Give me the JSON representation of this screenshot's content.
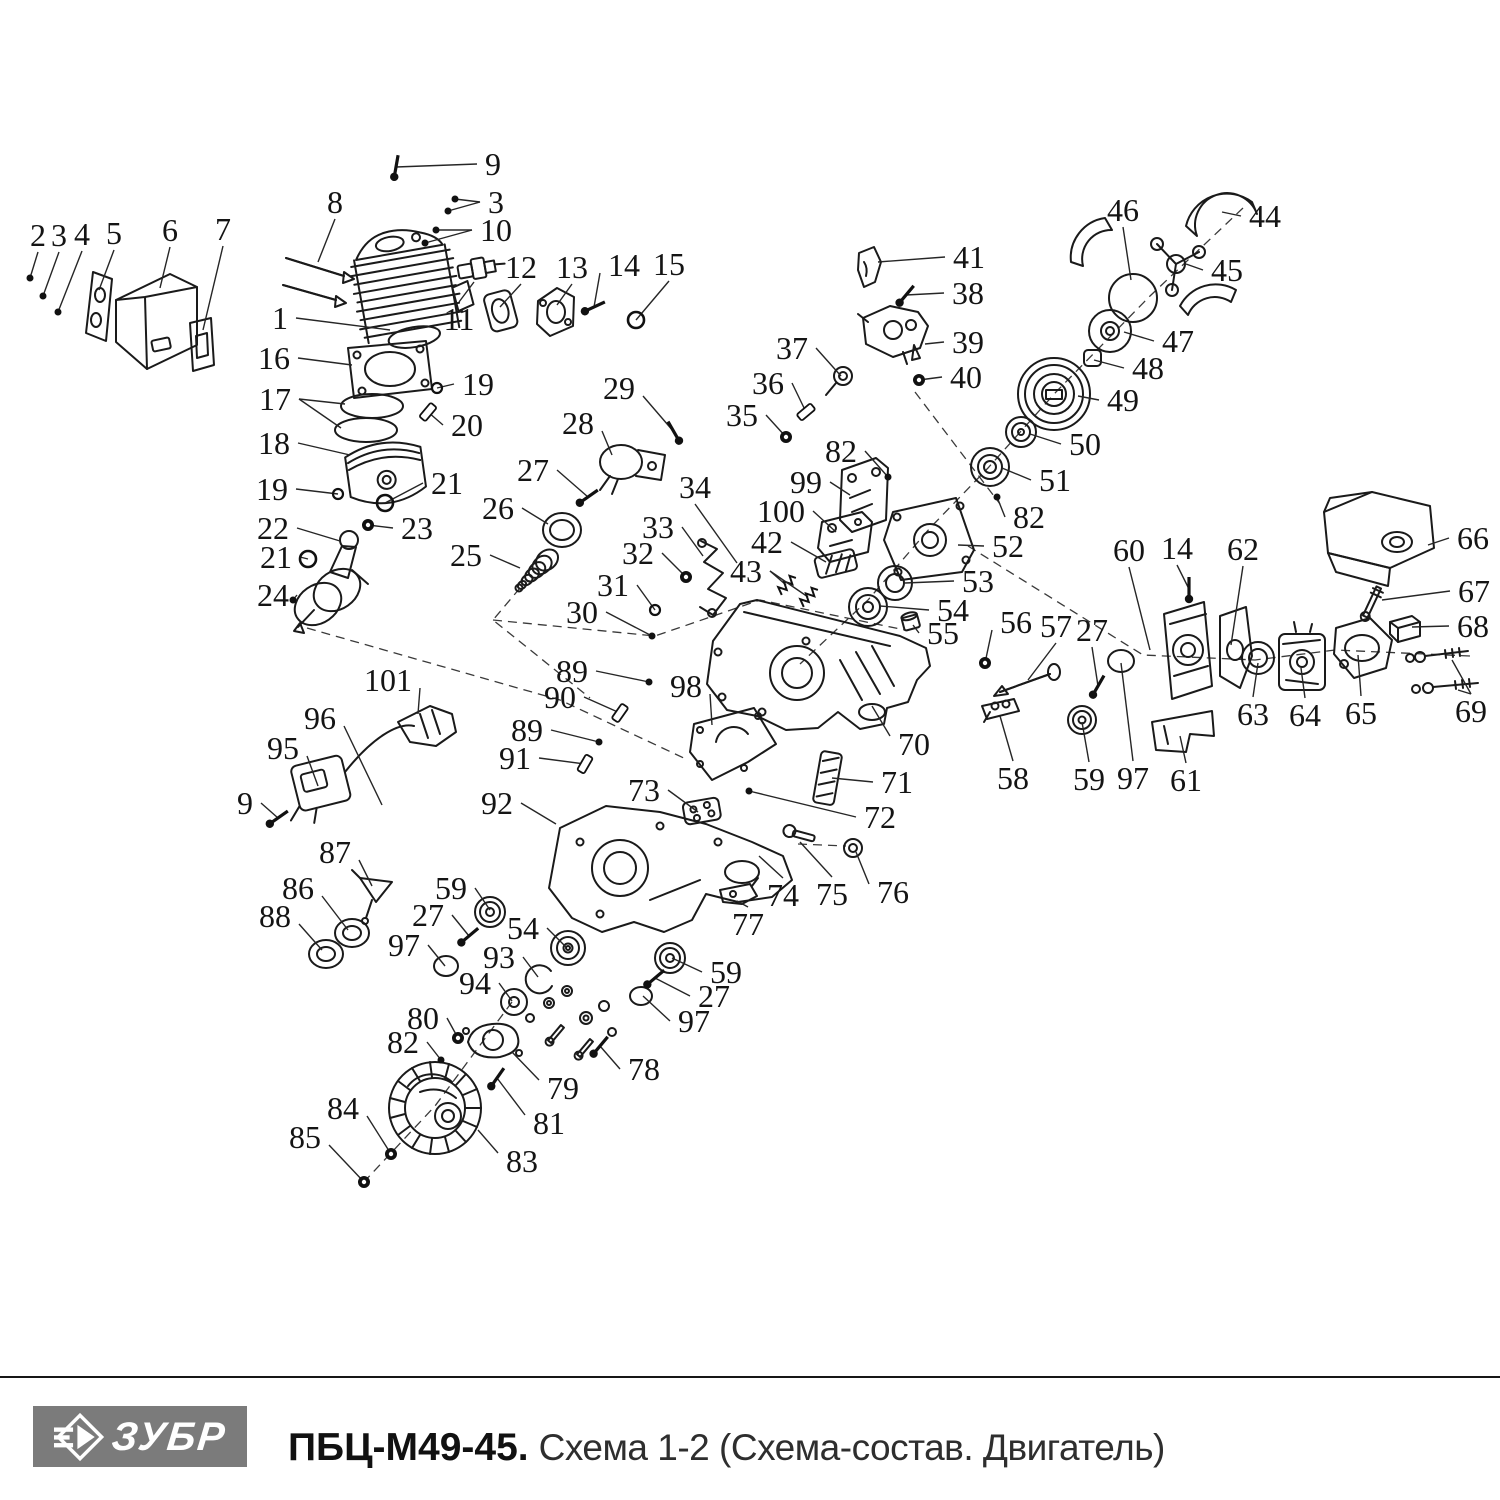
{
  "footer": {
    "brand": "ЗУБР",
    "model": "ПБЦ-М49-45.",
    "subtitle": "Схема 1-2 (Схема-состав. Двигатель)"
  },
  "diagram": {
    "callouts": [
      {
        "n": "2",
        "x": 38,
        "y": 235,
        "tx": 30,
        "ty": 278,
        "kind": "dot"
      },
      {
        "n": "3",
        "x": 59,
        "y": 235,
        "tx": 43,
        "ty": 296,
        "kind": "dot"
      },
      {
        "n": "4",
        "x": 82,
        "y": 234,
        "tx": 58,
        "ty": 312,
        "kind": "dot"
      },
      {
        "n": "5",
        "x": 114,
        "y": 233,
        "tx": 99,
        "ty": 290,
        "kind": "none"
      },
      {
        "n": "6",
        "x": 170,
        "y": 230,
        "tx": 160,
        "ty": 288,
        "kind": "none"
      },
      {
        "n": "7",
        "x": 223,
        "y": 229,
        "tx": 203,
        "ty": 330,
        "kind": "none"
      },
      {
        "n": "8",
        "x": 335,
        "y": 202,
        "tx": 318,
        "ty": 262,
        "kind": "none"
      },
      {
        "n": "9",
        "x": 493,
        "y": 164,
        "tx": 396,
        "ty": 167,
        "kind": "bolt",
        "rot": -80
      },
      {
        "n": "3",
        "x": 496,
        "y": 202,
        "tx": 455,
        "ty": 199,
        "kind": "dot",
        "t2": [
          448,
          211
        ]
      },
      {
        "n": "10",
        "x": 496,
        "y": 230,
        "tx": 436,
        "ty": 230,
        "kind": "dot",
        "t2": [
          425,
          243
        ]
      },
      {
        "n": "1",
        "x": 280,
        "y": 318,
        "tx": 390,
        "ty": 330,
        "kind": "none"
      },
      {
        "n": "11",
        "x": 459,
        "y": 319,
        "tx": 474,
        "ty": 282,
        "kind": "none"
      },
      {
        "n": "12",
        "x": 521,
        "y": 267,
        "tx": 500,
        "ty": 307,
        "kind": "none"
      },
      {
        "n": "13",
        "x": 572,
        "y": 267,
        "tx": 557,
        "ty": 305,
        "kind": "none"
      },
      {
        "n": "14",
        "x": 624,
        "y": 265,
        "tx": 594,
        "ty": 307,
        "kind": "bolt",
        "rot": -25
      },
      {
        "n": "15",
        "x": 669,
        "y": 264,
        "tx": 636,
        "ty": 320,
        "kind": "ring"
      },
      {
        "n": "16",
        "x": 274,
        "y": 358,
        "tx": 352,
        "ty": 365,
        "kind": "none"
      },
      {
        "n": "17",
        "x": 275,
        "y": 399,
        "tx": 345,
        "ty": 404,
        "kind": "none",
        "t2": [
          341,
          428
        ]
      },
      {
        "n": "18",
        "x": 274,
        "y": 443,
        "tx": 350,
        "ty": 455,
        "kind": "none"
      },
      {
        "n": "19",
        "x": 478,
        "y": 384,
        "tx": 437,
        "ty": 388,
        "kind": "ringS"
      },
      {
        "n": "20",
        "x": 467,
        "y": 425,
        "tx": 428,
        "ty": 412,
        "kind": "pin",
        "rot": -50
      },
      {
        "n": "21",
        "x": 447,
        "y": 483,
        "tx": 385,
        "ty": 503,
        "kind": "ring"
      },
      {
        "n": "19",
        "x": 272,
        "y": 489,
        "tx": 338,
        "ty": 494,
        "kind": "ringS"
      },
      {
        "n": "22",
        "x": 273,
        "y": 528,
        "tx": 340,
        "ty": 541,
        "kind": "none"
      },
      {
        "n": "23",
        "x": 417,
        "y": 528,
        "tx": 368,
        "ty": 525,
        "kind": "nut"
      },
      {
        "n": "21",
        "x": 276,
        "y": 557,
        "tx": 308,
        "ty": 559,
        "kind": "ring"
      },
      {
        "n": "24",
        "x": 273,
        "y": 595,
        "tx": 293,
        "ty": 600,
        "kind": "dot"
      },
      {
        "n": "25",
        "x": 466,
        "y": 555,
        "tx": 520,
        "ty": 568,
        "kind": "none"
      },
      {
        "n": "26",
        "x": 498,
        "y": 508,
        "tx": 548,
        "ty": 524,
        "kind": "none"
      },
      {
        "n": "27",
        "x": 533,
        "y": 470,
        "tx": 588,
        "ty": 497,
        "kind": "bolt",
        "rot": -35
      },
      {
        "n": "28",
        "x": 578,
        "y": 423,
        "tx": 612,
        "ty": 455,
        "kind": "none"
      },
      {
        "n": "29",
        "x": 619,
        "y": 388,
        "tx": 674,
        "ty": 432,
        "kind": "bolt",
        "rot": -120
      },
      {
        "n": "30",
        "x": 582,
        "y": 612,
        "tx": 652,
        "ty": 636,
        "kind": "dot"
      },
      {
        "n": "31",
        "x": 613,
        "y": 585,
        "tx": 655,
        "ty": 610,
        "kind": "ringS"
      },
      {
        "n": "32",
        "x": 638,
        "y": 553,
        "tx": 686,
        "ty": 577,
        "kind": "nut"
      },
      {
        "n": "33",
        "x": 658,
        "y": 527,
        "tx": 703,
        "ty": 556,
        "kind": "none"
      },
      {
        "n": "34",
        "x": 695,
        "y": 487,
        "tx": 737,
        "ty": 563,
        "kind": "none"
      },
      {
        "n": "35",
        "x": 742,
        "y": 415,
        "tx": 786,
        "ty": 437,
        "kind": "nut"
      },
      {
        "n": "36",
        "x": 768,
        "y": 383,
        "tx": 806,
        "ty": 412,
        "kind": "pin",
        "rot": -40
      },
      {
        "n": "37",
        "x": 792,
        "y": 348,
        "tx": 841,
        "ty": 376,
        "kind": "none"
      },
      {
        "n": "38",
        "x": 968,
        "y": 293,
        "tx": 906,
        "ty": 295,
        "kind": "bolt",
        "rot": -50
      },
      {
        "n": "39",
        "x": 968,
        "y": 342,
        "tx": 925,
        "ty": 344,
        "kind": "none"
      },
      {
        "n": "40",
        "x": 966,
        "y": 377,
        "tx": 919,
        "ty": 380,
        "kind": "nut"
      },
      {
        "n": "41",
        "x": 969,
        "y": 257,
        "tx": 878,
        "ty": 262,
        "kind": "none"
      },
      {
        "n": "42",
        "x": 767,
        "y": 542,
        "tx": 826,
        "ty": 562,
        "kind": "none"
      },
      {
        "n": "43",
        "x": 746,
        "y": 571,
        "tx": 786,
        "ty": 585,
        "kind": "spring",
        "t2": [
          808,
          597
        ]
      },
      {
        "n": "44",
        "x": 1265,
        "y": 216,
        "tx": 1222,
        "ty": 212,
        "kind": "none"
      },
      {
        "n": "45",
        "x": 1227,
        "y": 270,
        "tx": 1186,
        "ty": 264,
        "kind": "none"
      },
      {
        "n": "46",
        "x": 1123,
        "y": 210,
        "tx": 1131,
        "ty": 280,
        "kind": "none"
      },
      {
        "n": "47",
        "x": 1178,
        "y": 341,
        "tx": 1124,
        "ty": 332,
        "kind": "none"
      },
      {
        "n": "48",
        "x": 1148,
        "y": 368,
        "tx": 1094,
        "ty": 360,
        "kind": "none"
      },
      {
        "n": "49",
        "x": 1123,
        "y": 400,
        "tx": 1078,
        "ty": 396,
        "kind": "none"
      },
      {
        "n": "50",
        "x": 1085,
        "y": 444,
        "tx": 1030,
        "ty": 434,
        "kind": "none"
      },
      {
        "n": "51",
        "x": 1055,
        "y": 480,
        "tx": 1002,
        "ty": 468,
        "kind": "none"
      },
      {
        "n": "82",
        "x": 841,
        "y": 451,
        "tx": 888,
        "ty": 477,
        "kind": "dot"
      },
      {
        "n": "99",
        "x": 806,
        "y": 482,
        "tx": 850,
        "ty": 495,
        "kind": "none"
      },
      {
        "n": "100",
        "x": 781,
        "y": 511,
        "tx": 836,
        "ty": 532,
        "kind": "none"
      },
      {
        "n": "82",
        "x": 1029,
        "y": 517,
        "tx": 997,
        "ty": 497,
        "kind": "dot"
      },
      {
        "n": "52",
        "x": 1008,
        "y": 546,
        "tx": 958,
        "ty": 545,
        "kind": "none"
      },
      {
        "n": "53",
        "x": 978,
        "y": 581,
        "tx": 905,
        "ty": 583,
        "kind": "none"
      },
      {
        "n": "54",
        "x": 953,
        "y": 610,
        "tx": 880,
        "ty": 606,
        "kind": "none"
      },
      {
        "n": "55",
        "x": 943,
        "y": 633,
        "tx": 913,
        "ty": 625,
        "kind": "none"
      },
      {
        "n": "56",
        "x": 1016,
        "y": 622,
        "tx": 985,
        "ty": 663,
        "kind": "nut"
      },
      {
        "n": "57",
        "x": 1056,
        "y": 626,
        "tx": 1028,
        "ty": 680,
        "kind": "none"
      },
      {
        "n": "27",
        "x": 1092,
        "y": 630,
        "tx": 1098,
        "ty": 686,
        "kind": "bolt",
        "rot": -60
      },
      {
        "n": "60",
        "x": 1129,
        "y": 550,
        "tx": 1150,
        "ty": 650,
        "kind": "none"
      },
      {
        "n": "14",
        "x": 1177,
        "y": 548,
        "tx": 1189,
        "ty": 589,
        "kind": "bolt",
        "rot": -90
      },
      {
        "n": "62",
        "x": 1243,
        "y": 549,
        "tx": 1231,
        "ty": 645,
        "kind": "none"
      },
      {
        "n": "66",
        "x": 1473,
        "y": 538,
        "tx": 1428,
        "ty": 545,
        "kind": "none"
      },
      {
        "n": "67",
        "x": 1474,
        "y": 591,
        "tx": 1382,
        "ty": 600,
        "kind": "none"
      },
      {
        "n": "68",
        "x": 1473,
        "y": 626,
        "tx": 1412,
        "ty": 627,
        "kind": "none"
      },
      {
        "n": "69",
        "x": 1471,
        "y": 711,
        "tx": 1452,
        "ty": 660,
        "kind": "none",
        "t2": [
          1458,
          690
        ]
      },
      {
        "n": "63",
        "x": 1253,
        "y": 714,
        "tx": 1258,
        "ty": 663,
        "kind": "none"
      },
      {
        "n": "64",
        "x": 1305,
        "y": 715,
        "tx": 1301,
        "ty": 668,
        "kind": "none"
      },
      {
        "n": "65",
        "x": 1361,
        "y": 713,
        "tx": 1358,
        "ty": 655,
        "kind": "none"
      },
      {
        "n": "58",
        "x": 1013,
        "y": 778,
        "tx": 1000,
        "ty": 716,
        "kind": "none"
      },
      {
        "n": "59",
        "x": 1089,
        "y": 779,
        "tx": 1082,
        "ty": 722,
        "kind": "none"
      },
      {
        "n": "97",
        "x": 1133,
        "y": 778,
        "tx": 1121,
        "ty": 663,
        "kind": "none"
      },
      {
        "n": "61",
        "x": 1186,
        "y": 780,
        "tx": 1180,
        "ty": 736,
        "kind": "none"
      },
      {
        "n": "70",
        "x": 914,
        "y": 744,
        "tx": 872,
        "ty": 706,
        "kind": "none"
      },
      {
        "n": "71",
        "x": 897,
        "y": 782,
        "tx": 832,
        "ty": 778,
        "kind": "none"
      },
      {
        "n": "72",
        "x": 880,
        "y": 817,
        "tx": 749,
        "ty": 791,
        "kind": "dot"
      },
      {
        "n": "73",
        "x": 644,
        "y": 790,
        "tx": 698,
        "ty": 812,
        "kind": "none"
      },
      {
        "n": "74",
        "x": 783,
        "y": 895,
        "tx": 759,
        "ty": 856,
        "kind": "none"
      },
      {
        "n": "75",
        "x": 832,
        "y": 894,
        "tx": 800,
        "ty": 842,
        "kind": "none"
      },
      {
        "n": "76",
        "x": 893,
        "y": 892,
        "tx": 856,
        "ty": 852,
        "kind": "none"
      },
      {
        "n": "77",
        "x": 748,
        "y": 924,
        "tx": 737,
        "ty": 901,
        "kind": "none"
      },
      {
        "n": "89",
        "x": 572,
        "y": 671,
        "tx": 649,
        "ty": 682,
        "kind": "dot"
      },
      {
        "n": "90",
        "x": 560,
        "y": 697,
        "tx": 620,
        "ty": 713,
        "kind": "pin",
        "rot": -55
      },
      {
        "n": "98",
        "x": 686,
        "y": 686,
        "tx": 712,
        "ty": 725,
        "kind": "none"
      },
      {
        "n": "89",
        "x": 527,
        "y": 730,
        "tx": 599,
        "ty": 742,
        "kind": "dot"
      },
      {
        "n": "91",
        "x": 515,
        "y": 758,
        "tx": 585,
        "ty": 764,
        "kind": "pin",
        "rot": -60
      },
      {
        "n": "96",
        "x": 320,
        "y": 718,
        "tx": 382,
        "ty": 805,
        "kind": "none"
      },
      {
        "n": "95",
        "x": 283,
        "y": 748,
        "tx": 318,
        "ty": 786,
        "kind": "none"
      },
      {
        "n": "9",
        "x": 245,
        "y": 803,
        "tx": 278,
        "ty": 818,
        "kind": "bolt",
        "rot": -35
      },
      {
        "n": "92",
        "x": 497,
        "y": 803,
        "tx": 556,
        "ty": 824,
        "kind": "none"
      },
      {
        "n": "101",
        "x": 388,
        "y": 680,
        "tx": 418,
        "ty": 714,
        "kind": "none"
      },
      {
        "n": "87",
        "x": 335,
        "y": 852,
        "tx": 372,
        "ty": 886,
        "kind": "none"
      },
      {
        "n": "86",
        "x": 298,
        "y": 888,
        "tx": 348,
        "ty": 930,
        "kind": "none"
      },
      {
        "n": "88",
        "x": 275,
        "y": 916,
        "tx": 322,
        "ty": 950,
        "kind": "none"
      },
      {
        "n": "59",
        "x": 451,
        "y": 888,
        "tx": 490,
        "ty": 910,
        "kind": "none"
      },
      {
        "n": "27",
        "x": 428,
        "y": 915,
        "tx": 469,
        "ty": 936,
        "kind": "bolt",
        "rot": -40
      },
      {
        "n": "54",
        "x": 523,
        "y": 928,
        "tx": 566,
        "ty": 947,
        "kind": "none"
      },
      {
        "n": "97",
        "x": 404,
        "y": 945,
        "tx": 445,
        "ty": 966,
        "kind": "none"
      },
      {
        "n": "93",
        "x": 499,
        "y": 957,
        "tx": 538,
        "ty": 977,
        "kind": "none"
      },
      {
        "n": "94",
        "x": 475,
        "y": 983,
        "tx": 512,
        "ty": 1001,
        "kind": "none"
      },
      {
        "n": "59",
        "x": 726,
        "y": 972,
        "tx": 672,
        "ty": 958,
        "kind": "none"
      },
      {
        "n": "27",
        "x": 714,
        "y": 996,
        "tx": 655,
        "ty": 978,
        "kind": "bolt",
        "rot": -40
      },
      {
        "n": "97",
        "x": 694,
        "y": 1021,
        "tx": 643,
        "ty": 996,
        "kind": "none"
      },
      {
        "n": "78",
        "x": 644,
        "y": 1069,
        "tx": 600,
        "ty": 1046,
        "kind": "bolt",
        "rot": -50
      },
      {
        "n": "80",
        "x": 423,
        "y": 1018,
        "tx": 458,
        "ty": 1038,
        "kind": "nut"
      },
      {
        "n": "82",
        "x": 403,
        "y": 1042,
        "tx": 441,
        "ty": 1060,
        "kind": "dot"
      },
      {
        "n": "79",
        "x": 563,
        "y": 1088,
        "tx": 512,
        "ty": 1052,
        "kind": "none"
      },
      {
        "n": "81",
        "x": 549,
        "y": 1123,
        "tx": 497,
        "ty": 1078,
        "kind": "bolt",
        "rot": -55
      },
      {
        "n": "84",
        "x": 343,
        "y": 1108,
        "tx": 391,
        "ty": 1154,
        "kind": "nut"
      },
      {
        "n": "85",
        "x": 305,
        "y": 1137,
        "tx": 364,
        "ty": 1182,
        "kind": "nut"
      },
      {
        "n": "83",
        "x": 522,
        "y": 1161,
        "tx": 478,
        "ty": 1130,
        "kind": "none"
      }
    ]
  }
}
